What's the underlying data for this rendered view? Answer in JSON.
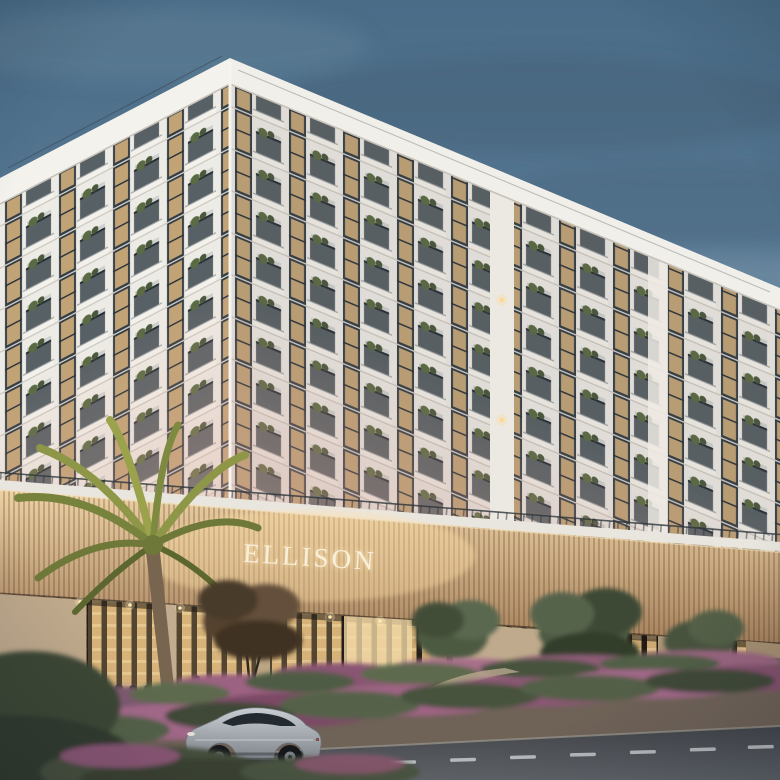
{
  "scene": {
    "sign": {
      "text": "ELLISON"
    },
    "palette": {
      "sky_top": "#4a6c87",
      "sky_mid": "#60819c",
      "sky_horizon": "#93a8b4",
      "facade_white": "#edebe5",
      "window_frame": "#333d45",
      "window_glow": "#dab57f",
      "facade_blush": "#dfa896",
      "podium_top": "#eed2a4",
      "podium_bottom": "#a5815c",
      "storefront_glass": "#e2ba7e",
      "storefront_frame": "#241d17",
      "pier_beige": "#bfa98c",
      "walkway": "#b0a08a",
      "meadow_pink": "#9c6282",
      "meadow_green": "#4f5c44",
      "street_dark": "#43454a",
      "street_light": "#5f6368",
      "car_silver_light": "#c9ced3",
      "car_silver_dark": "#82888e",
      "palm_frond": "#8d9747",
      "palm_trunk": "#77654f",
      "sign_text": "#f8efdc"
    }
  }
}
